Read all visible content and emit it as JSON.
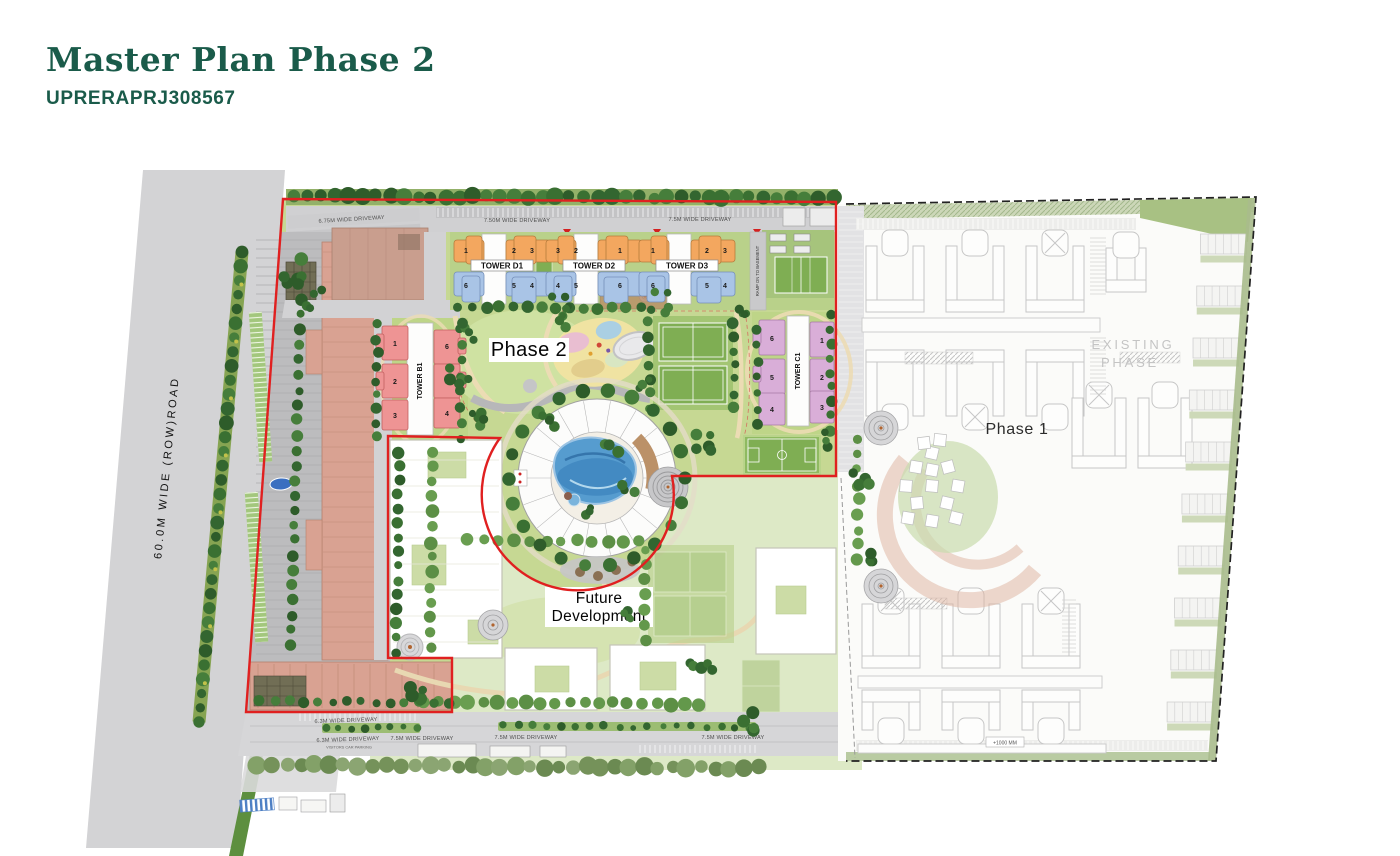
{
  "header": {
    "title": "Master Plan Phase 2",
    "rera": "UPRERAPRJ308567"
  },
  "road_label": "60.0M WIDE (ROW)ROAD",
  "labels": {
    "phase2": "Phase 2",
    "phase1": "Phase 1",
    "future_1": "Future",
    "future_2": "Development",
    "existing_1": "EXISTING",
    "existing_2": "PHASE",
    "level": "+1000 MM"
  },
  "driveways": {
    "d675": "6.75M WIDE DRIVEWAY",
    "d600": "6.00M WIDE DRIVEWAY",
    "d750": "7.50M WIDE DRIVEWAY",
    "d75_top_right": "7.5M WIDE DRIVEWAY",
    "d63_a": "6.3M WIDE DRIVEWAY",
    "d63_b": "6.3M WIDE DRIVEWAY",
    "visitors": "VISITORS CAR PARKING",
    "d75_b1": "7.5M WIDE DRIVEWAY",
    "d75_b2": "7.5M WIDE DRIVEWAY",
    "d75_b3": "7.5M WIDE DRIVEWAY"
  },
  "ramps": {
    "to_basement_1": "RAMP TO",
    "to_basement_2": "BASEMENT",
    "on_to": "RAMP ON TO BASEMENT",
    "dn_to": "RAMP DN TO BASEMENT"
  },
  "towers": {
    "d1": {
      "name": "TOWER D1",
      "top": [
        "1",
        "2",
        "3"
      ],
      "bottom": [
        "6",
        "5",
        "4"
      ]
    },
    "d2": {
      "name": "TOWER D2",
      "top": [
        "3",
        "2",
        "1"
      ],
      "bottom": [
        "4",
        "5",
        "6"
      ]
    },
    "d3": {
      "name": "TOWER D3",
      "top": [
        "1",
        "2",
        "3"
      ],
      "bottom": [
        "6",
        "5",
        "4"
      ]
    },
    "b1": {
      "name": "TOWER B1",
      "left": [
        "1",
        "2",
        "3"
      ],
      "right": [
        "6",
        "5",
        "4"
      ]
    },
    "c1": {
      "name": "TOWER C1",
      "left": [
        "6",
        "5",
        "4"
      ],
      "right": [
        "1",
        "2",
        "3"
      ]
    }
  },
  "colors": {
    "title_green": "#1a5b4a",
    "boundary_red": "#e02020",
    "orange_unit": "#f3a75f",
    "blue_unit": "#a9c4e6",
    "pink_unit": "#ee9494",
    "lilac_unit": "#d9aed8",
    "pool_blue": "#569ccf",
    "lawn_green": "#c6d893"
  }
}
